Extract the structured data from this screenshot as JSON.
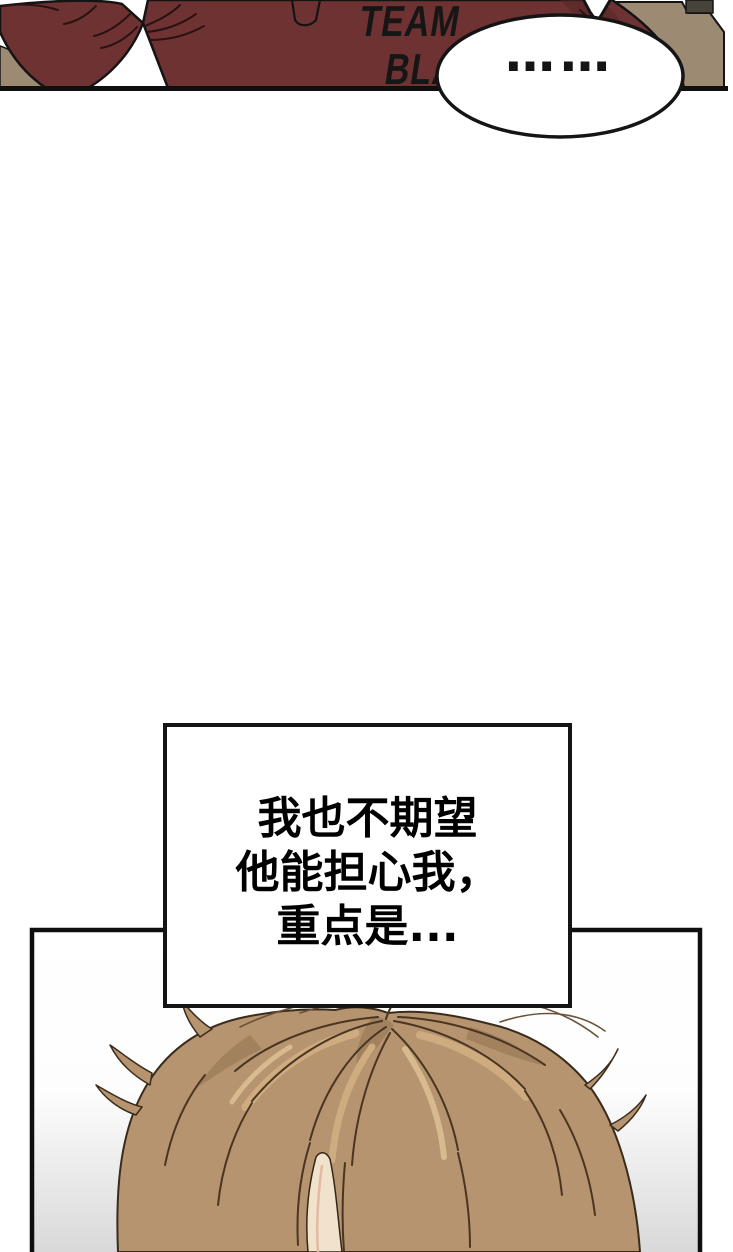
{
  "top_panel": {
    "shirt_print": {
      "line1": "TEAM",
      "line2": "BLA"
    },
    "speech_bubble": {
      "text": "……"
    }
  },
  "narration_box": {
    "lines": [
      "我也不期望",
      "他能担心我，",
      "重点是..."
    ]
  },
  "colors": {
    "outline": "#141414",
    "shirt": "#6e3232",
    "shirt_shadow": "#582626",
    "background_tan": "#9c8a72",
    "dark_object": "#49443b",
    "panel_white": "#ffffff",
    "hair_base": "#b5946f",
    "hair_shadow": "#9d7d5a",
    "hair_line": "#4a3521",
    "hair_highlight": "#cfab80",
    "skin_light": "#f1e2cb",
    "fade_grey": "#d9d9d9"
  }
}
